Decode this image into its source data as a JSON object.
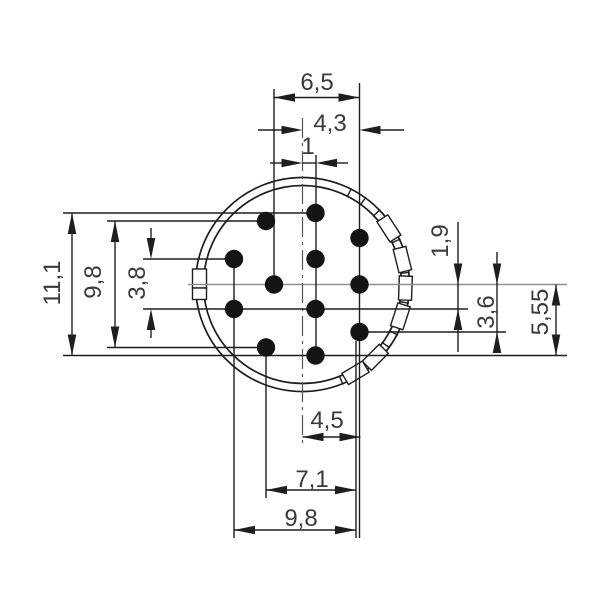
{
  "diagram": {
    "kind": "connector-insert-dimensional-drawing",
    "pin_count": 12,
    "colors": {
      "line": "#1e1e1e",
      "center_line": "#909090",
      "pin": "#141414",
      "text": "#3a3a3a",
      "background": "#ffffff"
    },
    "pins": [
      {
        "x": 315.5,
        "y": 213
      },
      {
        "x": 266,
        "y": 221
      },
      {
        "x": 359.5,
        "y": 238
      },
      {
        "x": 234,
        "y": 259
      },
      {
        "x": 315.5,
        "y": 259
      },
      {
        "x": 274,
        "y": 284.5
      },
      {
        "x": 359.5,
        "y": 284.5
      },
      {
        "x": 234,
        "y": 309
      },
      {
        "x": 315.5,
        "y": 309
      },
      {
        "x": 359.5,
        "y": 332
      },
      {
        "x": 266,
        "y": 347.5
      },
      {
        "x": 315.5,
        "y": 355.5
      }
    ],
    "pin_radius": 9.2,
    "dimensions": {
      "top": [
        {
          "label": "6,5"
        },
        {
          "label": "4,3"
        },
        {
          "label": "1"
        }
      ],
      "left": [
        {
          "label": "11,1"
        },
        {
          "label": "9,8"
        },
        {
          "label": "3,8"
        }
      ],
      "right": [
        {
          "label": "1,9"
        },
        {
          "label": "3,6"
        },
        {
          "label": "5,55"
        }
      ],
      "bottom": [
        {
          "label": "4,5"
        },
        {
          "label": "7,1"
        },
        {
          "label": "9,8"
        }
      ]
    }
  }
}
